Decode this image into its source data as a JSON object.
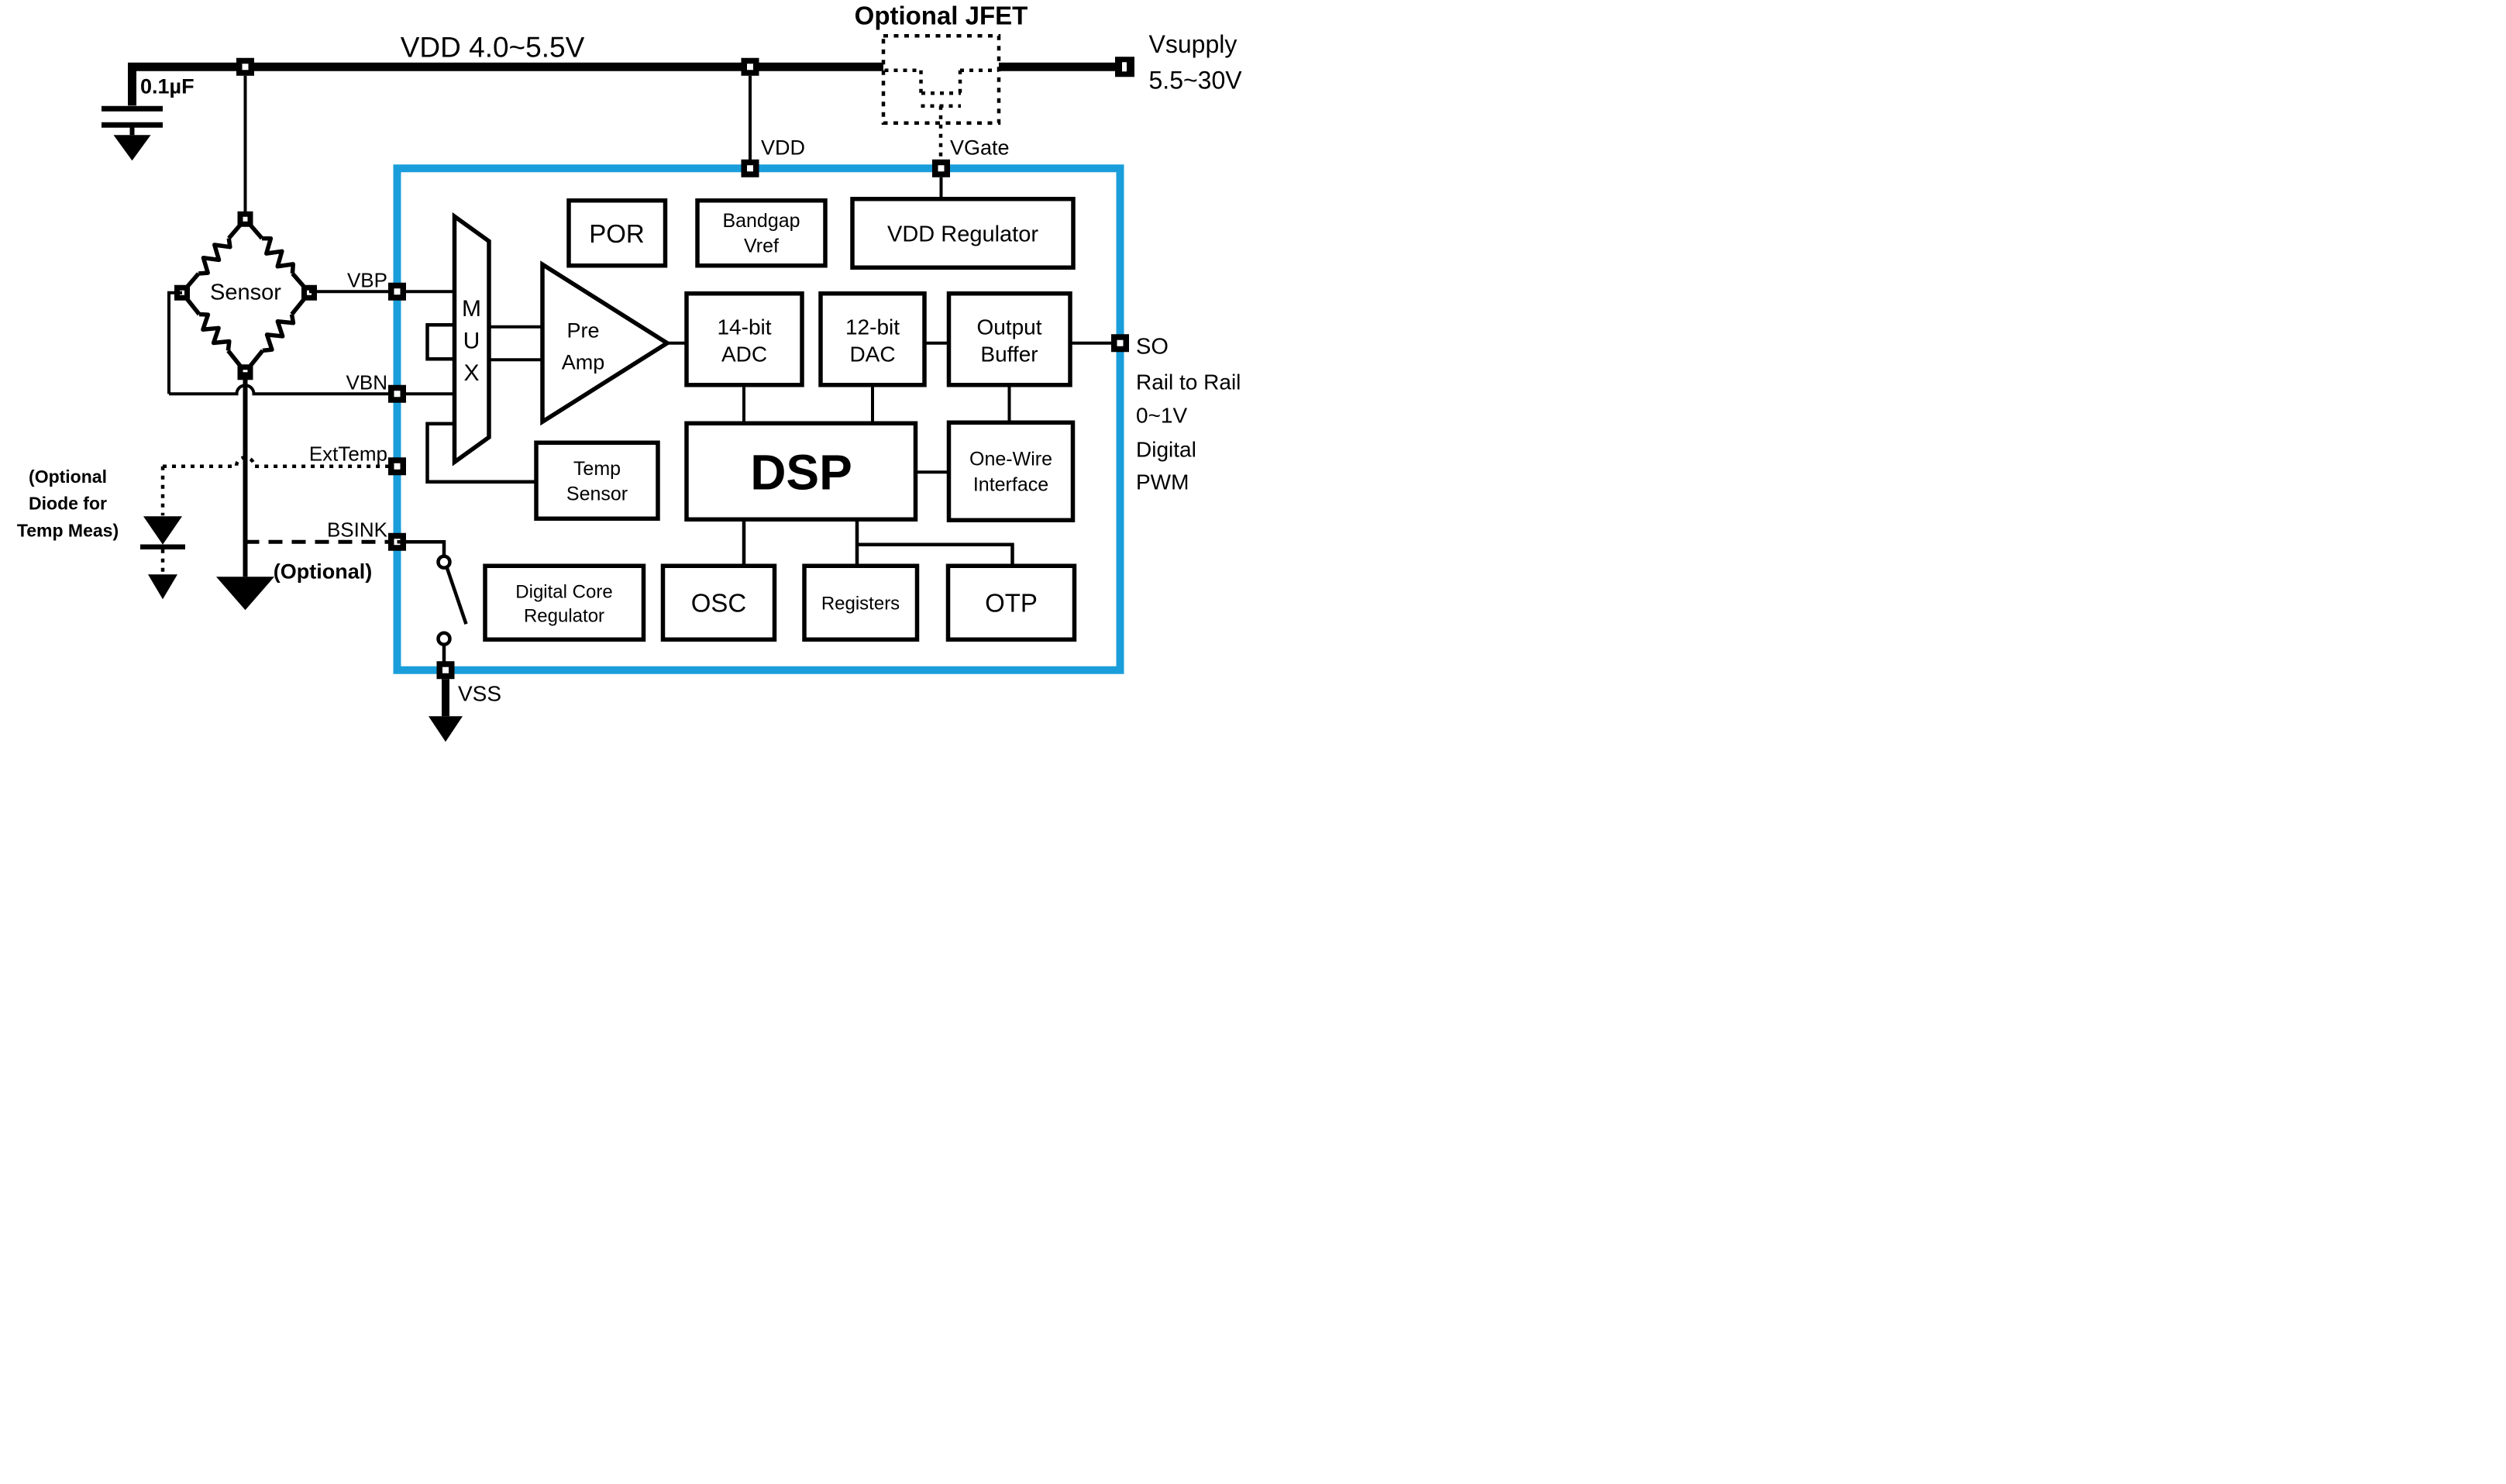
{
  "colors": {
    "chip_border": "#1A9EDB",
    "wire": "#000000",
    "background": "#FFFFFF"
  },
  "power": {
    "rail_label": "VDD  4.0~5.5V",
    "cap_label": "0.1µF",
    "jfet_label": "Optional JFET",
    "vsupply_line1": "Vsupply",
    "vsupply_line2": "5.5~30V",
    "vdd_pin_label": "VDD",
    "vgate_pin_label": "VGate"
  },
  "sensor": {
    "label": "Sensor",
    "vbp": "VBP",
    "vbn": "VBN",
    "exttemp": "ExtTemp",
    "bsink": "BSINK",
    "bsink_note": "(Optional)",
    "diode_note": [
      "(Optional",
      "Diode for",
      "Temp Meas)"
    ]
  },
  "chip": {
    "por": "POR",
    "bandgap": [
      "Bandgap",
      "Vref"
    ],
    "vdd_regulator": "VDD Regulator",
    "mux": [
      "M",
      "U",
      "X"
    ],
    "preamp": [
      "Pre",
      "Amp"
    ],
    "adc": [
      "14-bit",
      "ADC"
    ],
    "dac": [
      "12-bit",
      "DAC"
    ],
    "output_buffer": [
      "Output",
      "Buffer"
    ],
    "temp_sensor": [
      "Temp",
      "Sensor"
    ],
    "dsp": "DSP",
    "one_wire": [
      "One-Wire",
      "Interface"
    ],
    "digital_core_regulator": [
      "Digital Core",
      "Regulator"
    ],
    "osc": "OSC",
    "registers": "Registers",
    "otp": "OTP"
  },
  "output_pin": {
    "so": "SO",
    "line2": "Rail to Rail",
    "line3": "0~1V",
    "line4": "Digital",
    "line5": "PWM"
  },
  "vss_label": "VSS"
}
